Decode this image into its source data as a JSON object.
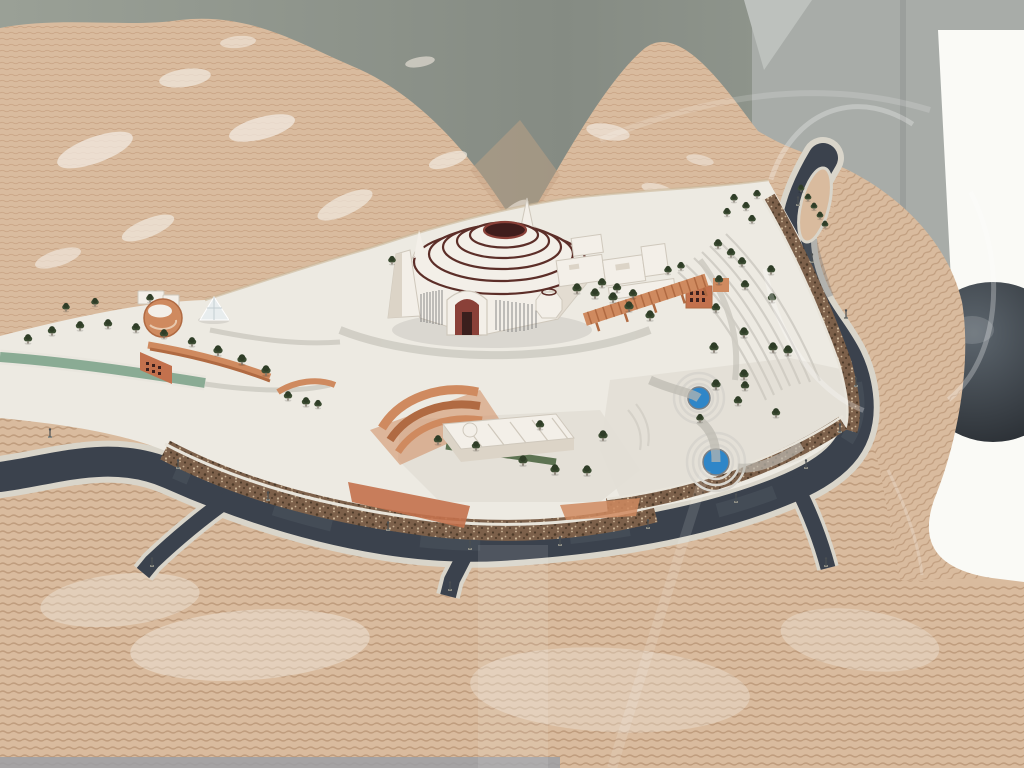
{
  "scene": {
    "description": "Photograph of an architectural scale model inside a glass display case: a white hilltop monument plaza with a stepped circular dome building, ring road, pools, trees and terraced tan mountains"
  },
  "colors": {
    "backdrop": "#858b83",
    "backdrop2": "#9aa096",
    "wall": "#a8aca8",
    "wall_edge": "#8e928f",
    "frame": "#bdc1bd",
    "window": "#fafaf6",
    "sphere1": "#5d666e",
    "sphere2": "#23272c",
    "mountain": "#d9bb9e",
    "contour": "#bd9372",
    "contour_strong": "#a67e5d",
    "plaster": "#f1eae0",
    "plaza": "#edeae2",
    "plaza_low": "#e2dfd6",
    "path_grey": "#bcb9b0",
    "step_grey": "#cfccc3",
    "road": "#3b424d",
    "road_worn": "#5a626d",
    "curb": "#d9d5ca",
    "stone": "#7c604a",
    "stone_dark": "#4c3a29",
    "stone_light": "#cab395",
    "rail": "#e8e4da",
    "terracotta": "#cf8a5f",
    "terracotta_dark": "#b06a42",
    "terracotta_deep": "#c3714d",
    "white_bld": "#f3efe8",
    "bld_shade": "#dcd4c7",
    "bld_line": "#cfc8bc",
    "dome_ring": "#5c2e28",
    "oculus": "#401d1c",
    "arch_red": "#8a4038",
    "door": "#3a1f1d",
    "window_slits": "#6f6f6f",
    "pool": "#2f86c8",
    "pool_rim": "#d8d5ce",
    "canal": "#8aab94",
    "lawn": "#5d7352",
    "tree": "#3d4d33",
    "tree_dark": "#2f3d27",
    "trunk": "#7c7468",
    "lamp": "#4a4f52",
    "base_strip": "#9b9fa4",
    "valley_shade": "#c6a585"
  },
  "trees": {
    "items": [
      [
        28,
        342,
        1
      ],
      [
        52,
        334,
        1
      ],
      [
        80,
        329,
        1
      ],
      [
        108,
        327,
        1
      ],
      [
        136,
        331,
        1
      ],
      [
        164,
        337,
        1
      ],
      [
        192,
        345,
        1
      ],
      [
        218,
        354,
        1.1
      ],
      [
        242,
        363,
        1.1
      ],
      [
        266,
        374,
        1.1
      ],
      [
        95,
        305,
        0.9
      ],
      [
        150,
        301,
        0.9
      ],
      [
        66,
        310,
        0.9
      ],
      [
        392,
        263,
        0.9
      ],
      [
        288,
        399,
        1
      ],
      [
        306,
        405,
        1
      ],
      [
        318,
        407,
        0.9
      ],
      [
        577,
        292,
        1.1
      ],
      [
        595,
        297,
        1.1
      ],
      [
        613,
        301,
        1.1
      ],
      [
        629,
        310,
        1.1
      ],
      [
        650,
        319,
        1.1
      ],
      [
        602,
        286,
        1
      ],
      [
        617,
        291,
        1
      ],
      [
        633,
        297,
        1
      ],
      [
        668,
        273,
        0.9
      ],
      [
        681,
        269,
        0.9
      ],
      [
        718,
        247,
        1
      ],
      [
        731,
        256,
        1
      ],
      [
        742,
        265,
        1
      ],
      [
        719,
        283,
        1
      ],
      [
        745,
        288,
        1
      ],
      [
        716,
        311,
        1
      ],
      [
        744,
        336,
        1.1
      ],
      [
        714,
        351,
        1.1
      ],
      [
        771,
        273,
        1
      ],
      [
        772,
        301,
        1
      ],
      [
        773,
        351,
        1.1
      ],
      [
        788,
        354,
        1.1
      ],
      [
        744,
        378,
        1.1
      ],
      [
        716,
        388,
        1.1
      ],
      [
        745,
        389,
        1
      ],
      [
        738,
        404,
        1
      ],
      [
        776,
        416,
        1
      ],
      [
        700,
        421,
        0.9
      ],
      [
        734,
        201,
        0.9
      ],
      [
        746,
        209,
        0.9
      ],
      [
        757,
        197,
        0.9
      ],
      [
        727,
        215,
        0.9
      ],
      [
        752,
        222,
        0.9
      ],
      [
        801,
        191,
        0.8
      ],
      [
        808,
        200,
        0.8
      ],
      [
        814,
        209,
        0.8
      ],
      [
        820,
        218,
        0.8
      ],
      [
        825,
        227,
        0.8
      ],
      [
        540,
        428,
        1
      ],
      [
        603,
        439,
        1.1
      ],
      [
        523,
        464,
        1.1
      ],
      [
        555,
        473,
        1.1
      ],
      [
        587,
        474,
        1.1
      ],
      [
        438,
        443,
        1
      ],
      [
        476,
        449,
        1
      ]
    ]
  },
  "lamps": {
    "items": [
      [
        50,
        437
      ],
      [
        178,
        468
      ],
      [
        268,
        500
      ],
      [
        388,
        530
      ],
      [
        470,
        549
      ],
      [
        560,
        545
      ],
      [
        648,
        528
      ],
      [
        736,
        502
      ],
      [
        806,
        468
      ],
      [
        840,
        432
      ],
      [
        856,
        386
      ],
      [
        846,
        318
      ],
      [
        812,
        262
      ],
      [
        798,
        205
      ],
      [
        152,
        566
      ],
      [
        450,
        590
      ],
      [
        826,
        566
      ]
    ]
  },
  "plaster_patches": {
    "items": [
      [
        95,
        150,
        40,
        13,
        -20,
        0.75
      ],
      [
        185,
        78,
        26,
        9,
        -8,
        0.7
      ],
      [
        262,
        128,
        34,
        11,
        -15,
        0.75
      ],
      [
        345,
        205,
        30,
        10,
        -25,
        0.7
      ],
      [
        448,
        160,
        20,
        7,
        -18,
        0.7
      ],
      [
        545,
        252,
        26,
        8,
        -30,
        0.7
      ],
      [
        608,
        132,
        22,
        8,
        10,
        0.65
      ],
      [
        658,
        190,
        17,
        6,
        15,
        0.6
      ],
      [
        238,
        42,
        18,
        6,
        -5,
        0.6
      ],
      [
        420,
        62,
        15,
        5,
        -10,
        0.6
      ],
      [
        148,
        228,
        28,
        9,
        -22,
        0.7
      ],
      [
        58,
        258,
        24,
        8,
        -18,
        0.65
      ],
      [
        515,
        210,
        16,
        6,
        -35,
        0.6
      ],
      [
        700,
        160,
        14,
        5,
        12,
        0.55
      ],
      [
        250,
        645,
        120,
        35,
        -4,
        0.45
      ],
      [
        610,
        690,
        140,
        42,
        3,
        0.35
      ],
      [
        860,
        640,
        80,
        30,
        8,
        0.35
      ],
      [
        120,
        600,
        80,
        26,
        -6,
        0.4
      ]
    ]
  }
}
